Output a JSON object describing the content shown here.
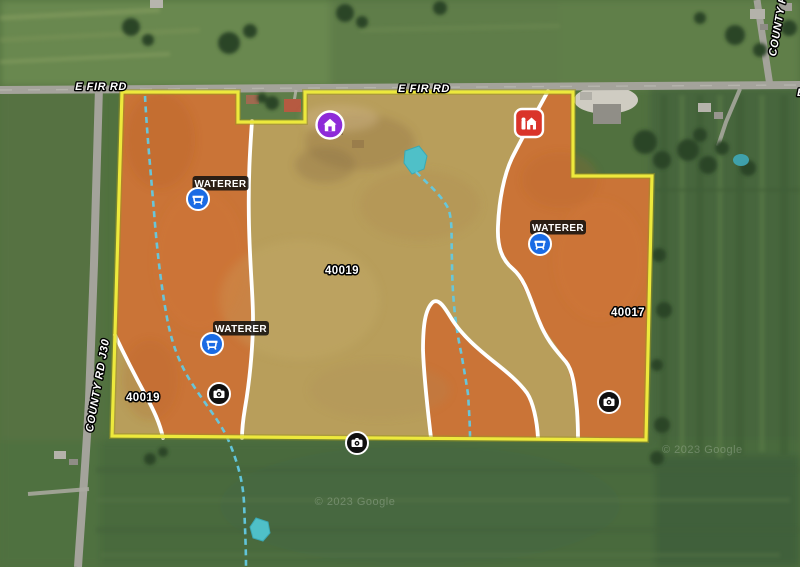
{
  "road_labels": {
    "e_fir_rd_left": "E FIR RD",
    "e_fir_rd_center": "E FIR RD",
    "e_fir_rd_right_fragment": "E FIR RD",
    "county_rd_j30": "COUNTY RD J30",
    "county_rd_top_right": "COUNTY RD"
  },
  "field_labels": {
    "center": "40019",
    "right": "40017",
    "bottom_left": "40019"
  },
  "markers": {
    "waterers": [
      {
        "label": "WATERER",
        "icon": "waterer-trough-icon"
      },
      {
        "label": "WATERER",
        "icon": "waterer-trough-icon"
      },
      {
        "label": "WATERER",
        "icon": "waterer-trough-icon"
      }
    ],
    "shed": {
      "icon": "shed-icon",
      "shape": "purple-circle"
    },
    "barn": {
      "icon": "barn-icon",
      "shape": "red-rounded-square"
    },
    "cameras": [
      {
        "icon": "camera-icon"
      },
      {
        "icon": "camera-icon"
      },
      {
        "icon": "camera-icon"
      }
    ]
  },
  "watermark": "© 2023 Google",
  "colors": {
    "parcel_outline": "#EDE93C",
    "zone_orange": "#CB7134",
    "zone_tan": "#C1A25D",
    "zone_divider_white": "#FFFFFF",
    "waterer_blue": "#1A6BE4",
    "shed_purple": "#8E2BD8",
    "barn_red": "#DA342A",
    "camera_black": "#101010",
    "stream_cyan": "#63C9E2",
    "pond_teal": "#4FC0C8",
    "label_bg_black": "#141210"
  }
}
